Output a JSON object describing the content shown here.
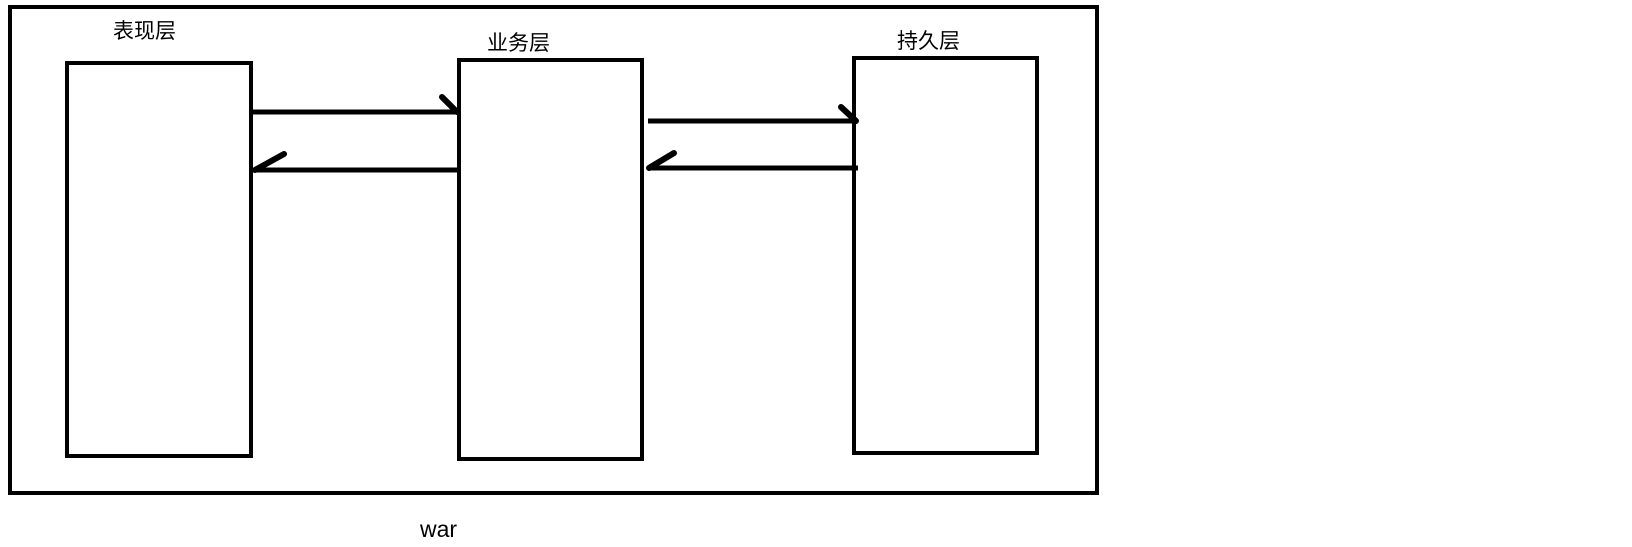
{
  "diagram": {
    "package_label": "war",
    "layers": [
      {
        "label": "表现层"
      },
      {
        "label": "业务层"
      },
      {
        "label": "持久层"
      }
    ],
    "arrows": [
      {
        "from": "表现层",
        "to": "业务层",
        "direction": "right"
      },
      {
        "from": "业务层",
        "to": "表现层",
        "direction": "left"
      },
      {
        "from": "业务层",
        "to": "持久层",
        "direction": "right"
      },
      {
        "from": "持久层",
        "to": "业务层",
        "direction": "left"
      }
    ],
    "colors": {
      "stroke": "#000000",
      "background": "#ffffff"
    }
  }
}
